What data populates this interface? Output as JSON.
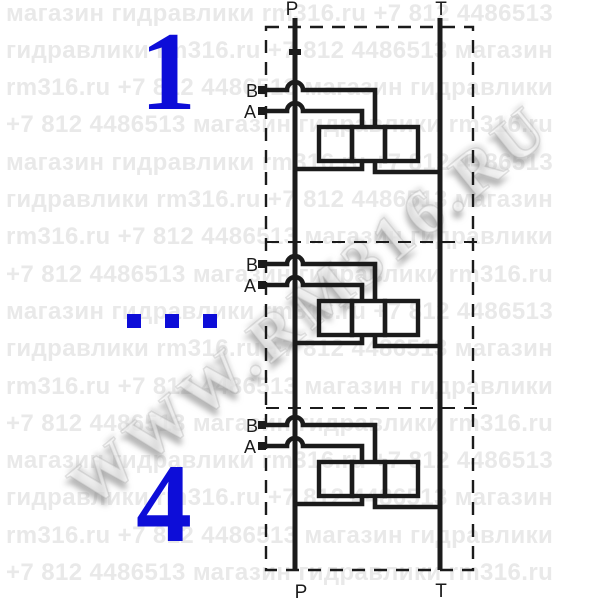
{
  "watermark": {
    "tile_phrases": [
      "магазин гидравлики rm316.ru +7 812 4486513",
      "гидравлики rm316.ru +7 812 4486513 магазин",
      "rm316.ru +7 812 4486513 магазин гидравлики",
      "+7 812 4486513 магазин гидравлики rm316.ru"
    ],
    "row_count": 16,
    "row_spacing_px": 37.3,
    "diagonal_text": "WWW.RM316.RU",
    "tile_color": "#e9e9e9"
  },
  "schematic": {
    "labels": {
      "p_top": "P",
      "t_top": "T",
      "p_bottom": "P",
      "t_bottom": "T",
      "b_port": "B",
      "a_port": "A"
    },
    "sections_shown": 3,
    "line_color": "#1b1b1b"
  },
  "annotations": {
    "first_section_number": "1",
    "last_section_number": "4",
    "accent_color": "#0d0dd8"
  }
}
